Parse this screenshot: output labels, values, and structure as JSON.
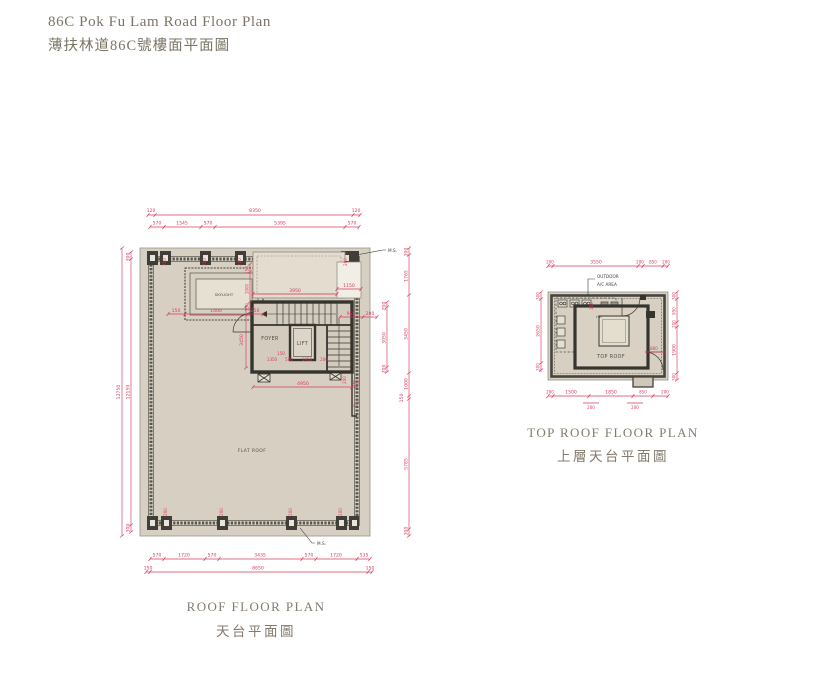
{
  "page": {
    "title_en": "86C Pok Fu Lam Road Floor Plan",
    "title_zh": "薄扶林道86C號樓面平面圖"
  },
  "colors": {
    "dimension_red": "#d63b5d",
    "wall_dark": "#35342f",
    "parapet_gray": "#57554c",
    "roof_fill": "#d7d0c2",
    "upper_roof_fill": "#e3dccf",
    "caption_gray": "#837b6c"
  },
  "roof_plan": {
    "caption_en": "ROOF FLOOR PLAN",
    "caption_zh": "天台平面圖",
    "labels": {
      "flat_roof": "FLAT ROOF",
      "skylight": "SKYLIGHT",
      "foyer": "FOYER",
      "lift": "LIFT",
      "ms": "M.S."
    },
    "dims": {
      "top1": [
        "120",
        "8350",
        "120"
      ],
      "top2": [
        "570",
        "1545",
        "570",
        "5395",
        "570"
      ],
      "bot1": [
        "570",
        "1720",
        "570",
        "3435",
        "570",
        "1720",
        "535"
      ],
      "bot2": [
        "150",
        "8650",
        "150"
      ],
      "left_outer": "12750",
      "left": [
        "300",
        "12150",
        "300"
      ],
      "right_outer": [
        "300",
        "1765",
        "3450",
        "1000",
        "150",
        "5785",
        "300"
      ],
      "right_inner": [
        "200",
        "3050",
        "200"
      ],
      "col_top": [
        "200",
        "200",
        "200",
        "200"
      ],
      "col_bot": [
        "200",
        "200",
        "200",
        "200"
      ],
      "upper": [
        "3950",
        "1150"
      ],
      "mid": [
        "950",
        "200"
      ],
      "skylight_row": [
        "150",
        "1400",
        "150"
      ],
      "skylight_col": [
        "150",
        "1000",
        "150"
      ],
      "foyer_col": "3450",
      "core_bottom": [
        "150",
        "1350",
        "500",
        "1950",
        "200"
      ],
      "below_core": [
        "4950",
        "150",
        "950",
        "200"
      ]
    }
  },
  "top_roof_plan": {
    "caption_en": "TOP ROOF FLOOR PLAN",
    "caption_zh": "上層天台平面圖",
    "labels": {
      "top_roof": "TOP ROOF",
      "outdoor_line1": "OUTDOOR",
      "outdoor_line2": "A/C AREA",
      "hr": "HR"
    },
    "dims": {
      "top": [
        "200",
        "3550",
        "200",
        "850",
        "200"
      ],
      "bottom": [
        "200",
        "1500",
        "1850",
        "850",
        "200"
      ],
      "bottom_sub": [
        "200",
        "200"
      ],
      "right": [
        "300",
        "950",
        "200",
        "1900",
        "300"
      ],
      "left": [
        "300",
        "2650",
        "300"
      ],
      "inner_v": "150",
      "inner_h": "860"
    }
  }
}
